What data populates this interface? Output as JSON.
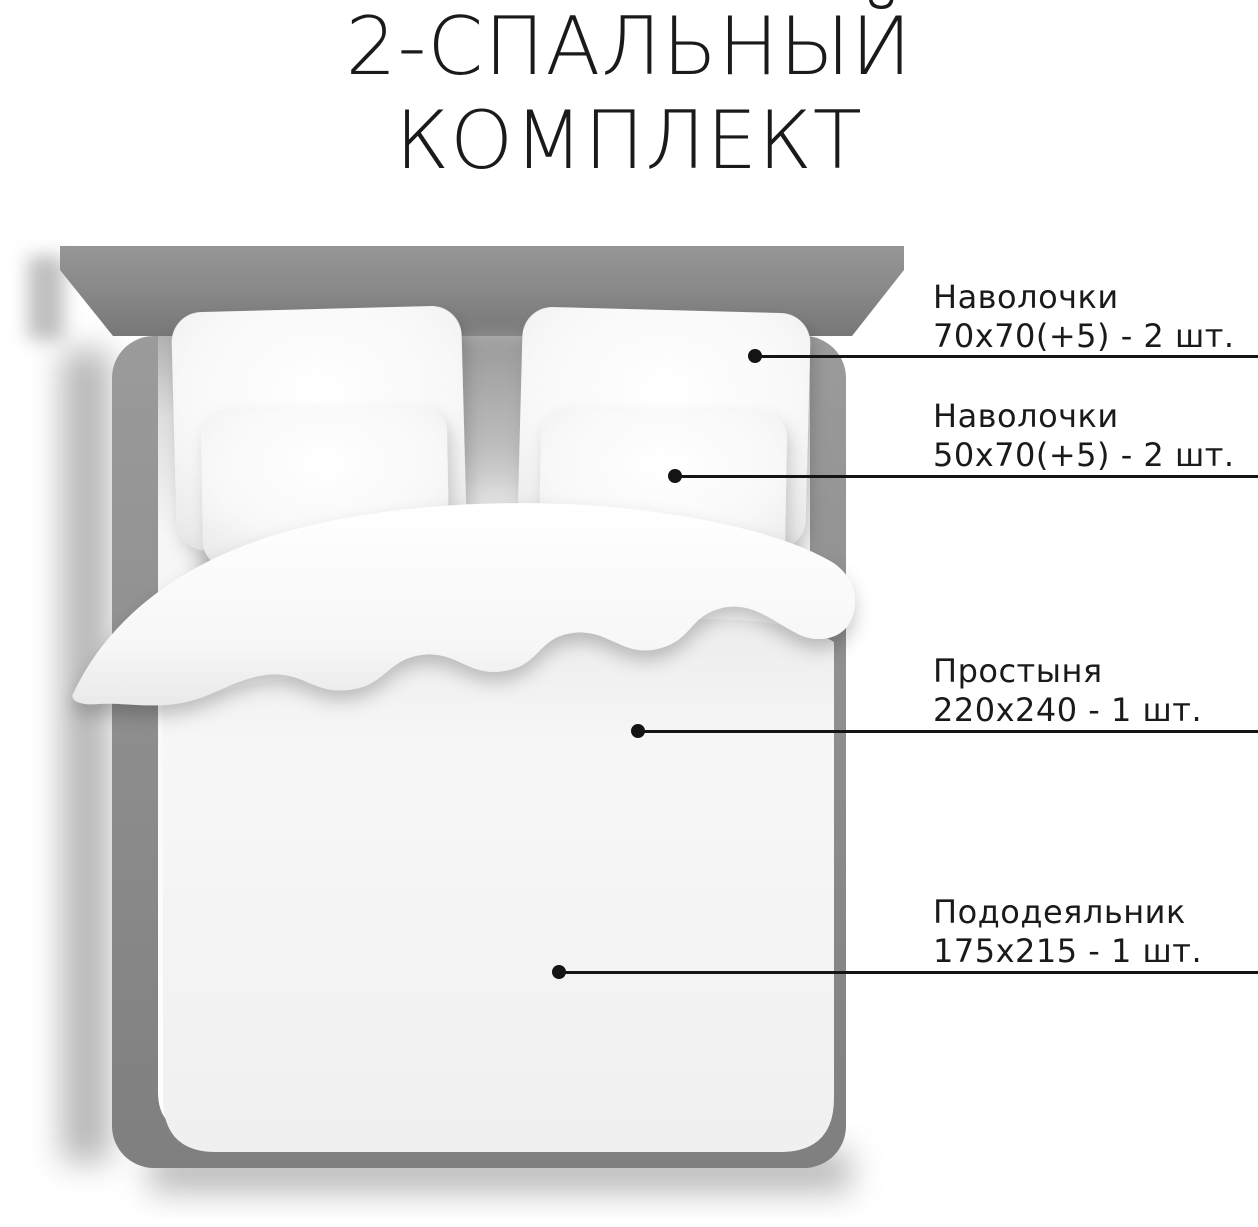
{
  "title": {
    "line1": "2-СПАЛЬНЫЙ",
    "line2": "КОМПЛЕКТ"
  },
  "callouts": [
    {
      "name": "Наволочки",
      "size": "70х70(+5) - 2 шт."
    },
    {
      "name": "Наволочки",
      "size": "50х70(+5) - 2 шт."
    },
    {
      "name": "Простыня",
      "size": "220х240 - 1 шт."
    },
    {
      "name": "Пододеяльник",
      "size": "175х215 - 1 шт."
    }
  ],
  "colors": {
    "background": "#ffffff",
    "text": "#1a1a1a",
    "line": "#141414",
    "headboard_gray": "#8a8a8a",
    "frame_gray": "#8d8d8d",
    "bedding_white": "#fafafa"
  }
}
